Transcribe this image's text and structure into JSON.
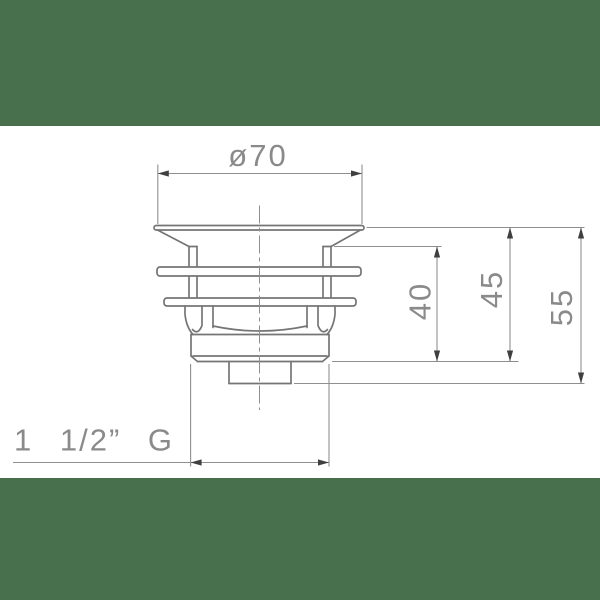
{
  "page": {
    "background_color": "#ffffff",
    "band_color": "#48704d",
    "outline_color": "#757575",
    "dimension_line_color": "#8f8f8f",
    "arrow_color": "#3f3f3f",
    "text_color": "#8a8a8a"
  },
  "drawing": {
    "dimensions": {
      "top_diameter": "ø70",
      "height_40": "40",
      "height_45": "45",
      "height_55": "55",
      "thread": "1 1/2” G"
    }
  }
}
